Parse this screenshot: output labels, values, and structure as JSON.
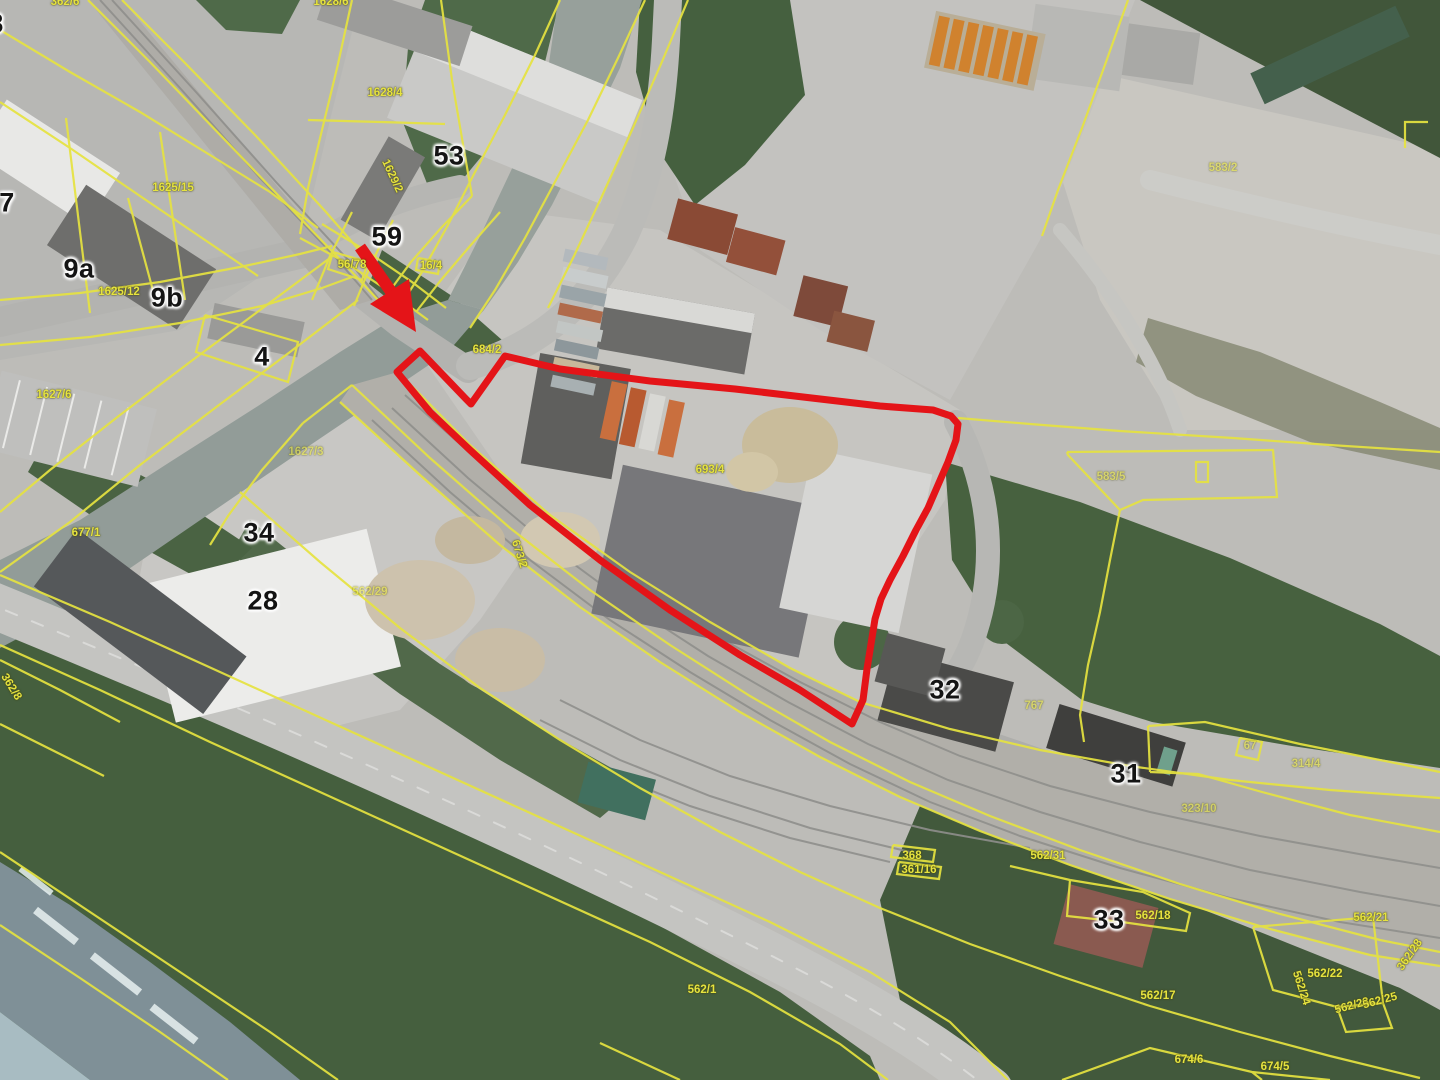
{
  "map": {
    "kind": "aerial-orthophoto-with-cadastral-overlay",
    "colors": {
      "highlight_red": "#e41418",
      "cadastral_yellow": "#e6e340",
      "building_label_black": "#141414"
    },
    "highlight": {
      "selected_parcel_outline": "red polygon around industrial site",
      "pointer_arrow": "red arrow pointing to north-west corner of selected parcel"
    },
    "building_number_labels": [
      {
        "text": "7",
        "x": 7,
        "y": 203
      },
      {
        "text": "9a",
        "x": 79,
        "y": 269
      },
      {
        "text": "9b",
        "x": 167,
        "y": 298
      },
      {
        "text": "4",
        "x": 262,
        "y": 357
      },
      {
        "text": "53",
        "x": 449,
        "y": 156
      },
      {
        "text": "59",
        "x": 387,
        "y": 237
      },
      {
        "text": "34",
        "x": 259,
        "y": 533
      },
      {
        "text": "28",
        "x": 263,
        "y": 601
      },
      {
        "text": "32",
        "x": 945,
        "y": 690
      },
      {
        "text": "31",
        "x": 1126,
        "y": 774
      },
      {
        "text": "33",
        "x": 1109,
        "y": 920
      },
      {
        "text": "8",
        "x": -4,
        "y": 24
      }
    ],
    "parcel_number_labels": [
      {
        "text": "1625/15",
        "x": 173,
        "y": 188,
        "rot": 0,
        "dim": false
      },
      {
        "text": "1625/12",
        "x": 119,
        "y": 292,
        "rot": 0,
        "dim": false
      },
      {
        "text": "1628/4",
        "x": 385,
        "y": 93,
        "rot": 0,
        "dim": false
      },
      {
        "text": "1629/2",
        "x": 392,
        "y": 176,
        "rot": 65,
        "dim": false
      },
      {
        "text": "362/6",
        "x": 65,
        "y": 2,
        "rot": 0,
        "dim": false
      },
      {
        "text": "1628/6",
        "x": 331,
        "y": 2,
        "rot": 0,
        "dim": false
      },
      {
        "text": "56/78",
        "x": 352,
        "y": 265,
        "rot": 0,
        "dim": false
      },
      {
        "text": "16/4",
        "x": 431,
        "y": 266,
        "rot": 0,
        "dim": false
      },
      {
        "text": "684/2",
        "x": 487,
        "y": 350,
        "rot": 0,
        "dim": false
      },
      {
        "text": "693/4",
        "x": 710,
        "y": 470,
        "rot": 0,
        "dim": false
      },
      {
        "text": "583/5",
        "x": 1111,
        "y": 477,
        "rot": 0,
        "dim": true
      },
      {
        "text": "583/2",
        "x": 1223,
        "y": 168,
        "rot": 0,
        "dim": true
      },
      {
        "text": "1627/6",
        "x": 54,
        "y": 395,
        "rot": 0,
        "dim": false
      },
      {
        "text": "1627/3",
        "x": 306,
        "y": 452,
        "rot": 0,
        "dim": true
      },
      {
        "text": "673/2",
        "x": 519,
        "y": 554,
        "rot": 72,
        "dim": false
      },
      {
        "text": "677/1",
        "x": 86,
        "y": 533,
        "rot": 0,
        "dim": false
      },
      {
        "text": "362/8",
        "x": 11,
        "y": 687,
        "rot": 58,
        "dim": false
      },
      {
        "text": "562/29",
        "x": 370,
        "y": 592,
        "rot": 0,
        "dim": true
      },
      {
        "text": "767",
        "x": 1034,
        "y": 706,
        "rot": 0,
        "dim": true
      },
      {
        "text": "314/4",
        "x": 1306,
        "y": 764,
        "rot": 0,
        "dim": true
      },
      {
        "text": "323/10",
        "x": 1199,
        "y": 809,
        "rot": 0,
        "dim": true
      },
      {
        "text": "67",
        "x": 1250,
        "y": 746,
        "rot": 0,
        "dim": true
      },
      {
        "text": "562/31",
        "x": 1048,
        "y": 856,
        "rot": 0,
        "dim": false
      },
      {
        "text": "368",
        "x": 912,
        "y": 856,
        "rot": 0,
        "dim": false
      },
      {
        "text": "361/16",
        "x": 919,
        "y": 870,
        "rot": 0,
        "dim": false
      },
      {
        "text": "562/18",
        "x": 1153,
        "y": 916,
        "rot": 0,
        "dim": false
      },
      {
        "text": "562/21",
        "x": 1371,
        "y": 918,
        "rot": 0,
        "dim": false
      },
      {
        "text": "362/28",
        "x": 1410,
        "y": 955,
        "rot": -55,
        "dim": false
      },
      {
        "text": "562/22",
        "x": 1325,
        "y": 974,
        "rot": 0,
        "dim": false
      },
      {
        "text": "562/24",
        "x": 1301,
        "y": 988,
        "rot": 72,
        "dim": false
      },
      {
        "text": "562/23",
        "x": 1352,
        "y": 1006,
        "rot": -15,
        "dim": false
      },
      {
        "text": "562/25",
        "x": 1380,
        "y": 1001,
        "rot": -15,
        "dim": false
      },
      {
        "text": "562/17",
        "x": 1158,
        "y": 996,
        "rot": 0,
        "dim": false
      },
      {
        "text": "674/6",
        "x": 1189,
        "y": 1060,
        "rot": 0,
        "dim": false
      },
      {
        "text": "674/5",
        "x": 1275,
        "y": 1067,
        "rot": 0,
        "dim": false
      },
      {
        "text": "562/1",
        "x": 702,
        "y": 990,
        "rot": 0,
        "dim": false
      }
    ]
  }
}
